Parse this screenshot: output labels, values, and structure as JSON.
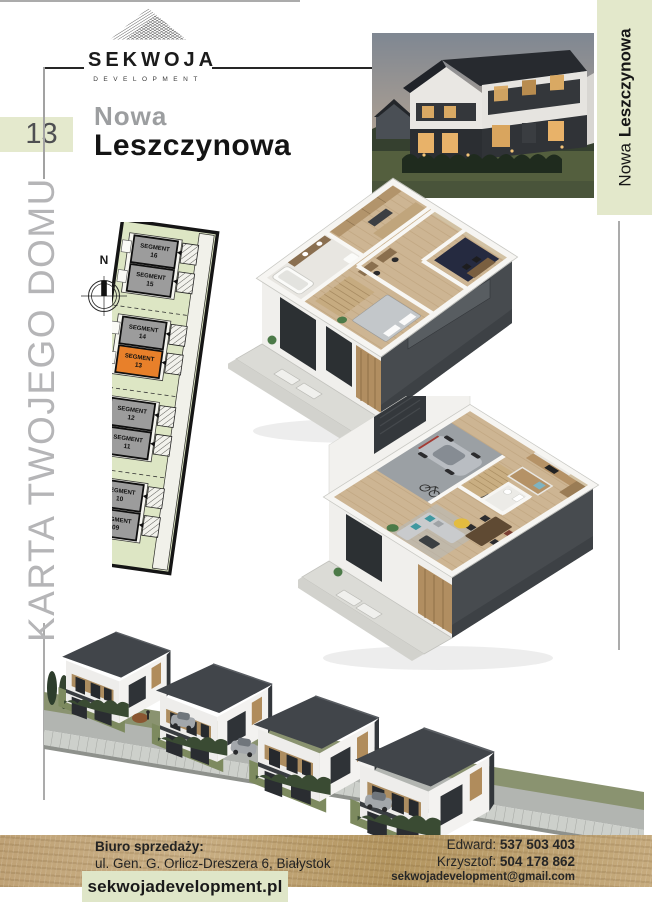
{
  "brand": {
    "name": "SEKWOJA",
    "subtitle": "DEVELOPMENT"
  },
  "card_number": "13",
  "project": {
    "prefix": "Nowa",
    "name": "Leszczynowa"
  },
  "side_caption": "KARTA TWOJEGO DOMU",
  "strip": {
    "prefix": "Nowa",
    "name": "Leszczynowa"
  },
  "compass_north": "N",
  "site_plan": {
    "highlighted": "SEGMENT 13",
    "segments": [
      {
        "word": "SEGMENT",
        "num": "16"
      },
      {
        "word": "SEGMENT",
        "num": "15"
      },
      {
        "word": "SEGMENT",
        "num": "14"
      },
      {
        "word": "SEGMENT",
        "num": "13"
      },
      {
        "word": "SEGMENT",
        "num": "12"
      },
      {
        "word": "SEGMENT",
        "num": "11"
      },
      {
        "word": "SEGMENT",
        "num": "10"
      },
      {
        "word": "SEGMENT",
        "num": "09"
      }
    ]
  },
  "footer": {
    "office_label": "Biuro sprzedaży:",
    "address": "ul. Gen. G. Orlicz-Dreszera 6, Białystok",
    "website": "sekwojadevelopment.pl",
    "contacts": [
      {
        "name": "Edward:",
        "phone": "537 503 403"
      },
      {
        "name": "Krzysztof:",
        "phone": "504 178 862"
      }
    ],
    "email": "sekwojadevelopment@gmail.com"
  },
  "colors": {
    "accent_green": "#e3e8cb",
    "highlight_orange": "#e8802a",
    "segment_gray": "#9c9c9c",
    "kraft_tan": "#c0a678",
    "roof_dark": "#42464a"
  }
}
